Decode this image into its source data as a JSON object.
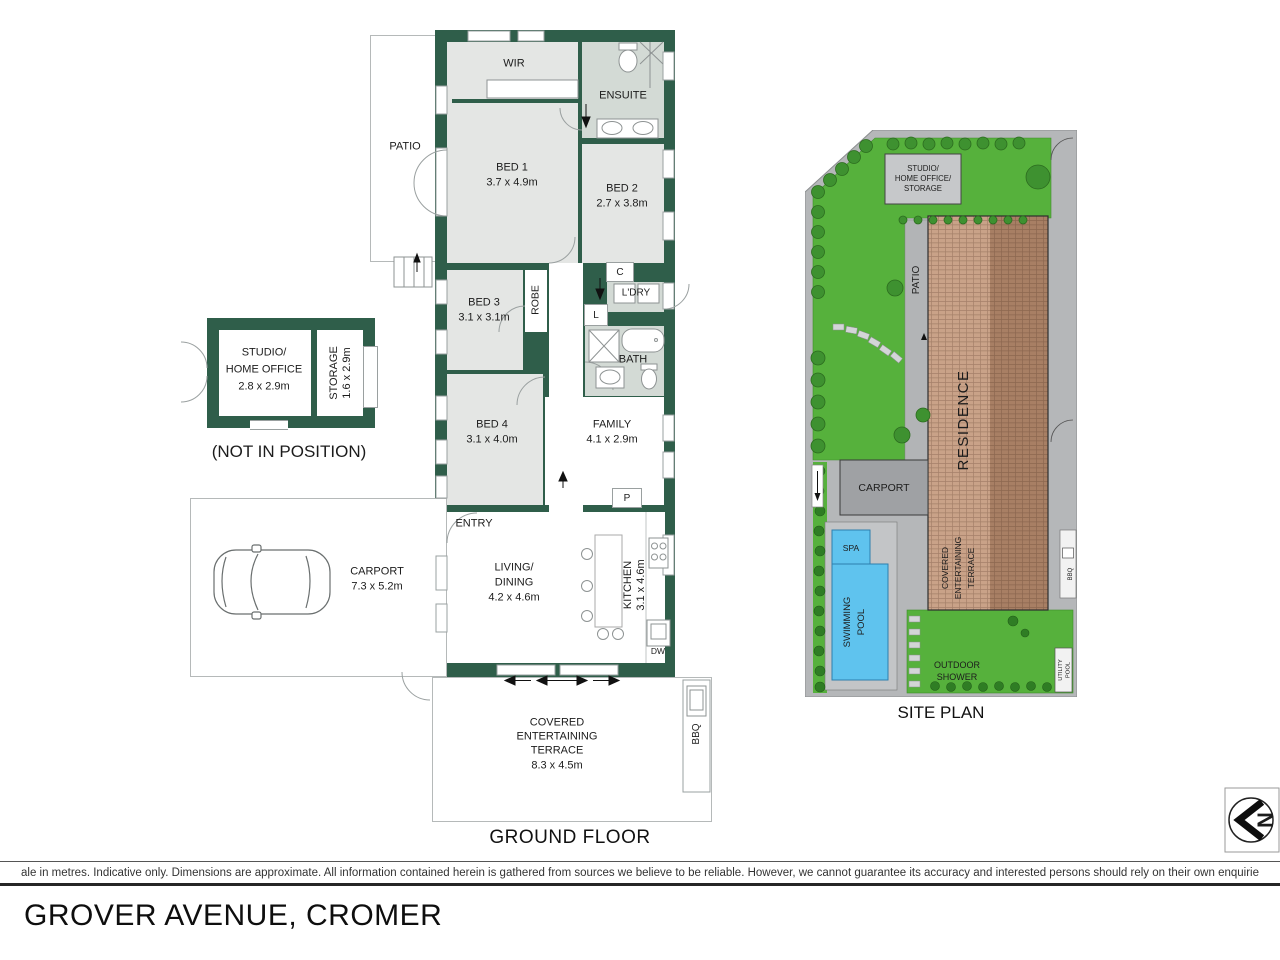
{
  "fp": {
    "patio": "PATIO",
    "wir": "WIR",
    "ensuite": "ENSUITE",
    "bed1": "BED 1",
    "bed1_dims": "3.7 x 4.9m",
    "bed2": "BED 2",
    "bed2_dims": "2.7 x 3.8m",
    "bed3": "BED 3",
    "bed3_dims": "3.1 x 3.1m",
    "bed4": "BED 4",
    "bed4_dims": "3.1 x 4.0m",
    "robe": "ROBE",
    "cupboard": "C",
    "ldry": "L'DRY",
    "linen": "L",
    "bath": "BATH",
    "family": "FAMILY",
    "family_dims": "4.1 x 2.9m",
    "entry": "ENTRY",
    "pantry": "P",
    "living1": "LIVING/",
    "living2": "DINING",
    "living_dims": "4.2 x 4.6m",
    "kitchen": "KITCHEN",
    "kitchen_dims": "3.1 x 4.6m",
    "dw": "DW",
    "carport": "CARPORT",
    "carport_dims": "7.3 x 5.2m",
    "terrace1": "COVERED",
    "terrace2": "ENTERTAINING",
    "terrace3": "TERRACE",
    "terrace_dims": "8.3 x 4.5m",
    "bbq": "BBQ",
    "studio1": "STUDIO/",
    "studio2": "HOME OFFICE",
    "studio_dims": "2.8 x 2.9m",
    "storage": "STORAGE",
    "storage_dims": "1.6 x 2.9m",
    "not_in_position": "(NOT IN POSITION)",
    "title": "GROUND FLOOR"
  },
  "site": {
    "studio1": "STUDIO/",
    "studio2": "HOME OFFICE/",
    "studio3": "STORAGE",
    "patio": "PATIO",
    "residence": "RESIDENCE",
    "carport": "CARPORT",
    "spa": "SPA",
    "pool1": "SWIMMING",
    "pool2": "POOL",
    "terrace1": "COVERED",
    "terrace2": "ENTERTAINING",
    "terrace3": "TERRACE",
    "shower1": "OUTDOOR",
    "shower2": "SHOWER",
    "bbq": "BBQ",
    "utility1": "UTILITY",
    "utility2": "POOL",
    "title": "SITE PLAN"
  },
  "footer": {
    "disclaimer": "ale in metres. Indicative only. Dimensions are approximate. All information contained herein is gathered from sources we believe to be reliable. However, we cannot guarantee its accuracy and interested persons should rely on their own enquirie",
    "address": "GROVER AVENUE, CROMER"
  },
  "compass": {
    "letter": "N"
  },
  "colors": {
    "wall": "#2f5e4a",
    "room": "#e4e6e4",
    "wet": "#d3dad5",
    "lawn": "#56b13c",
    "roof_light": "#c9a288",
    "roof_dark": "#a87f64",
    "path": "#b5b7b9",
    "pool": "#5fc3ee"
  }
}
